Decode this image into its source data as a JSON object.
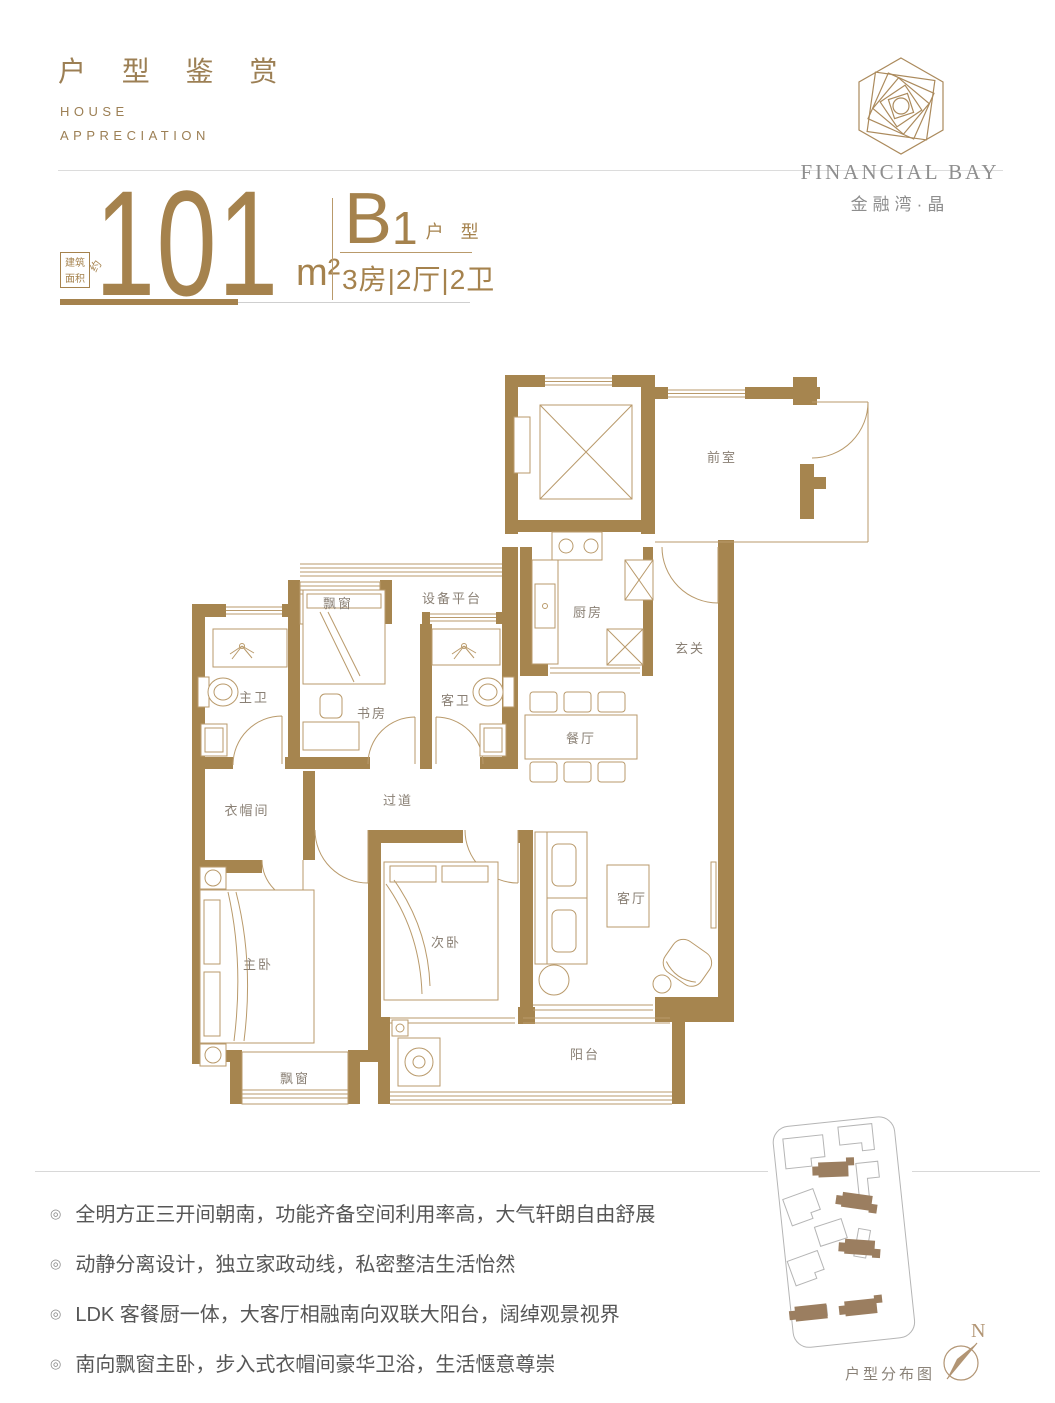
{
  "header": {
    "title": "户 型 鉴 赏",
    "subtitle_line1": "HOUSE",
    "subtitle_line2": "APPRECIATION"
  },
  "brand": {
    "name_en": "FINANCIAL BAY",
    "name_cn": "金融湾·晶",
    "logo_icon": "hexagon-spiral-logo"
  },
  "spec": {
    "area_label_line1": "建筑",
    "area_label_line2": "面积",
    "area_approx": "约",
    "area_value": "101",
    "area_unit": "m²",
    "unit_code": "B",
    "unit_number": "1",
    "unit_type_label": "户 型",
    "layout": "3房|2厅|2卫"
  },
  "floorplan": {
    "rooms": {
      "qianshi": "前室",
      "chufang": "厨房",
      "xuanguan": "玄关",
      "canting": "餐厅",
      "shebeipingtai": "设备平台",
      "piaochuang_top": "飘窗",
      "zhuwei": "主卫",
      "shufang": "书房",
      "kewei": "客卫",
      "yimaojian": "衣帽间",
      "guodao": "过道",
      "zhuwo": "主卧",
      "ciwo": "次卧",
      "keting": "客厅",
      "piaochuang_bottom": "飘窗",
      "yangtai": "阳台"
    }
  },
  "features": {
    "bullet_icon": "◎",
    "items": [
      "全明方正三开间朝南，功能齐备空间利用率高，大气轩朗自由舒展",
      "动静分离设计，独立家政动线，私密整洁生活怡然",
      "LDK 客餐厨一体，大客厅相融南向双联大阳台，阔绰观景视界",
      "南向飘窗主卧，步入式衣帽间豪华卫浴，生活惬意尊崇"
    ]
  },
  "siteplan": {
    "caption": "户型分布图",
    "compass_label": "N"
  },
  "colors": {
    "accent_gold": "#a5824d",
    "wall_brown": "#a6854f",
    "furniture_line": "#b99a6b",
    "label_gray": "#8a8075",
    "text_gray": "#565656"
  }
}
